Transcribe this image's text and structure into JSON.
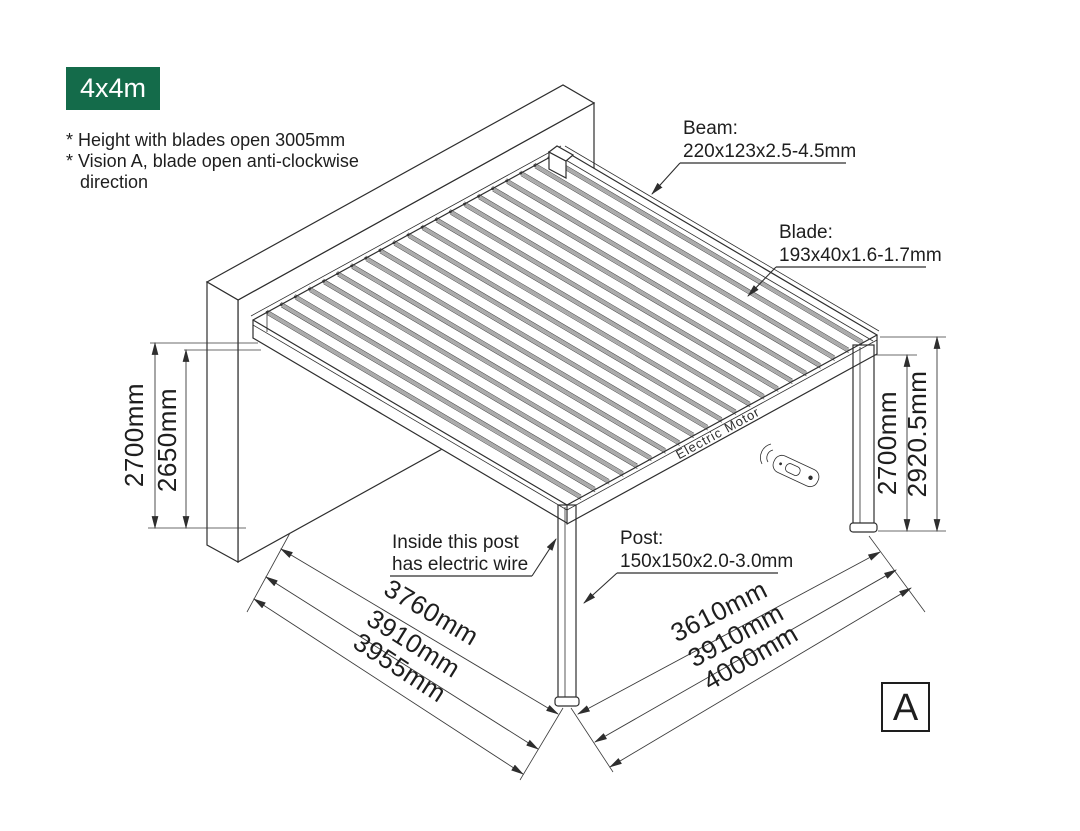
{
  "badge": {
    "label": "4x4m"
  },
  "notes": {
    "line1": "* Height with blades open 3005mm",
    "line2": "* Vision A, blade open anti-clockwise",
    "line3": "direction"
  },
  "callouts": {
    "beam": {
      "title": "Beam:",
      "size": "220x123x2.5-4.5mm"
    },
    "blade": {
      "title": "Blade:",
      "size": "193x40x1.6-1.7mm"
    },
    "post": {
      "title": "Post:",
      "size": "150x150x2.0-3.0mm"
    },
    "wire": {
      "line1": "Inside this post",
      "line2": "has electric wire"
    },
    "motor": {
      "label": "Electric Motor"
    }
  },
  "dimensions": {
    "left_outer": "2700mm",
    "left_inner": "2650mm",
    "right_inner": "2700mm",
    "right_outer": "2920.5mm",
    "front_left": [
      "3760mm",
      "3910mm",
      "3955mm"
    ],
    "front_right": [
      "3610mm",
      "3910mm",
      "4000mm"
    ]
  },
  "view_label": "A",
  "colors": {
    "badge_green": "#146b4a",
    "line": "#2e2e2e",
    "blade_gray": "#ababab"
  }
}
